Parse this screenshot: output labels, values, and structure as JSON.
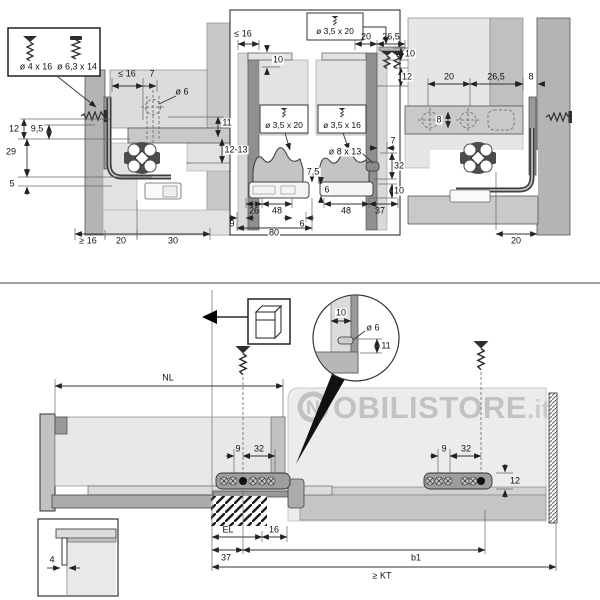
{
  "top": {
    "screw_box": {
      "screw1_label": "ø 4 x 16",
      "screw2_label": "ø 6,3 x 14"
    },
    "left_view": {
      "panel_max": "≤ 16",
      "offset7": "7",
      "hole_dia": "ø 6",
      "h12": "12",
      "h95": "9,5",
      "h29": "29",
      "v11": "11",
      "v1213": "12-13",
      "h5": "5",
      "back_min": "≥ 16",
      "w20": "20",
      "w30": "30"
    },
    "middle_view": {
      "screw_top": "ø 3,5 x 20",
      "t20": "20",
      "t265": "26,5",
      "t10": "10",
      "t12": "12",
      "left": {
        "max16": "≤ 16",
        "tab10": "10",
        "screw": "ø 3,5 x 20",
        "g75": "7,5",
        "b26": "26",
        "b48": "48",
        "b9": "9",
        "b6": "6",
        "b80": "80"
      },
      "right": {
        "screw": "ø 3,5 x 16",
        "dowel": "ø 8 x 13",
        "t7": "7",
        "v32": "32",
        "v10": "10",
        "v6": "6",
        "b48": "48",
        "b37": "37"
      }
    },
    "right_view": {
      "t20": "20",
      "t265": "26,5",
      "t8": "8",
      "hole8": "8",
      "b20": "20"
    }
  },
  "bottom": {
    "nl_label": "NL",
    "detail": {
      "t10": "10",
      "dia": "ø 6",
      "v11": "11"
    },
    "rail_left": {
      "d9": "9",
      "d32": "32"
    },
    "rail_right": {
      "d9": "9",
      "d32": "32",
      "v12": "12"
    },
    "base_dims": {
      "el": "EL",
      "n16": "16",
      "n37": "37",
      "b1": "b1",
      "kt": "≥ KT"
    },
    "inset": {
      "gap": "4"
    },
    "watermark": {
      "logo": "N",
      "name": "OBILISTORE",
      "tld": ".it"
    }
  }
}
